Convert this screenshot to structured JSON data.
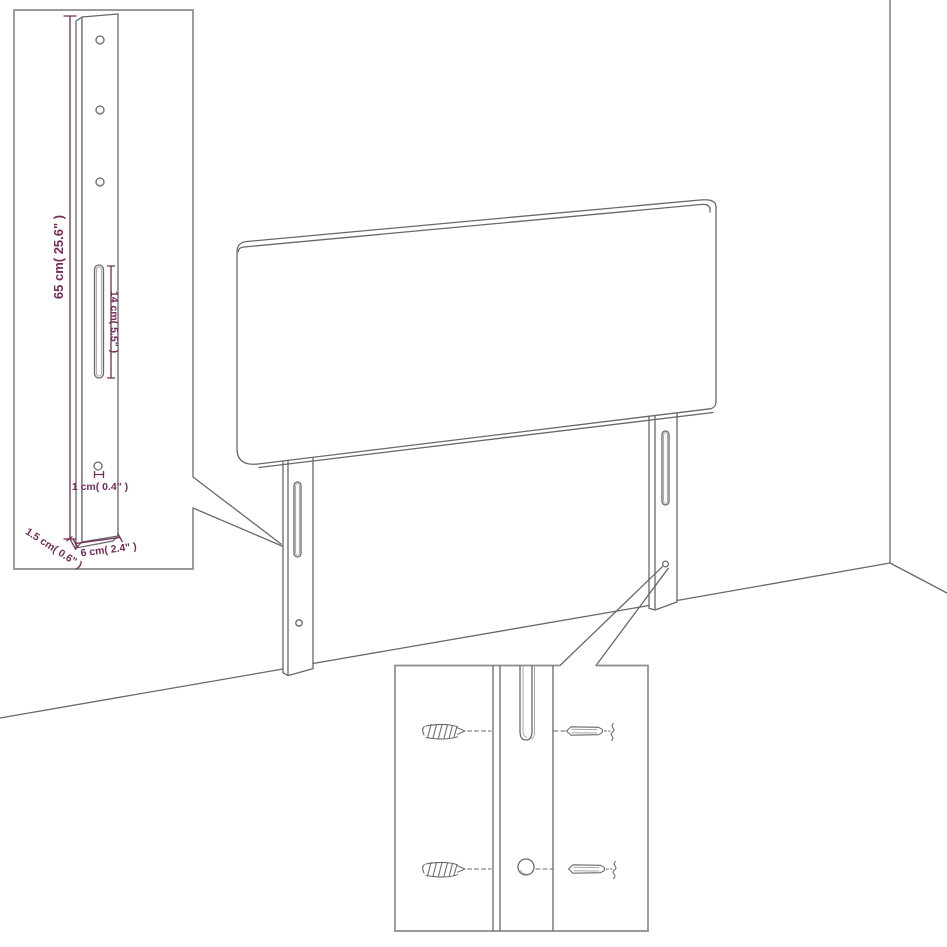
{
  "colors": {
    "background_color": "#ffffff",
    "line_color": "#686868",
    "inner_line_color": "#a8a8a8",
    "box_border_color": "#8c8c8c",
    "dimension_color": "#762b58"
  },
  "leg_dimension_inset": {
    "total_height_label": "65 cm( 25.6\" )",
    "slot_length_label": "14 cm( 5.5\" )",
    "hole_diameter_label": "1 cm( 0.4\" )",
    "leg_depth_label": "1.5 cm( 0.6\" )",
    "leg_width_label": "6 cm( 2.4\" )"
  }
}
